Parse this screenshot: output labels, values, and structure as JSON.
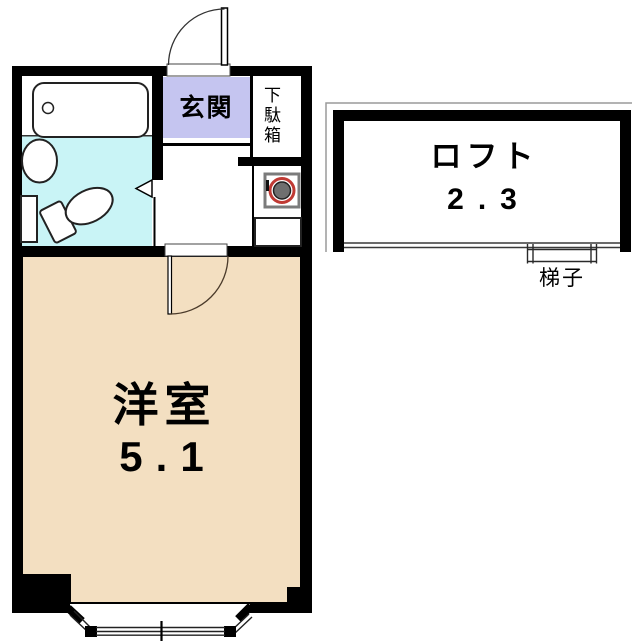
{
  "floorplan": {
    "entrance": {
      "label": "玄関"
    },
    "shoe_cabinet": {
      "label": "下駄箱"
    },
    "main_room": {
      "label": "洋室",
      "size": "5.1"
    },
    "loft": {
      "label": "ロフト",
      "size": "2.3"
    },
    "ladder": {
      "label": "梯子"
    }
  },
  "colors": {
    "wall": "#000000",
    "bathroom_floor": "#c9f4f6",
    "entrance_floor": "#c5c5f0",
    "main_room_floor": "#f3dfc1",
    "stove_ring_red": "#c03a34",
    "stove_burner_gray": "#6f6f6f",
    "stove_frame_gray": "#7b7b7b"
  }
}
